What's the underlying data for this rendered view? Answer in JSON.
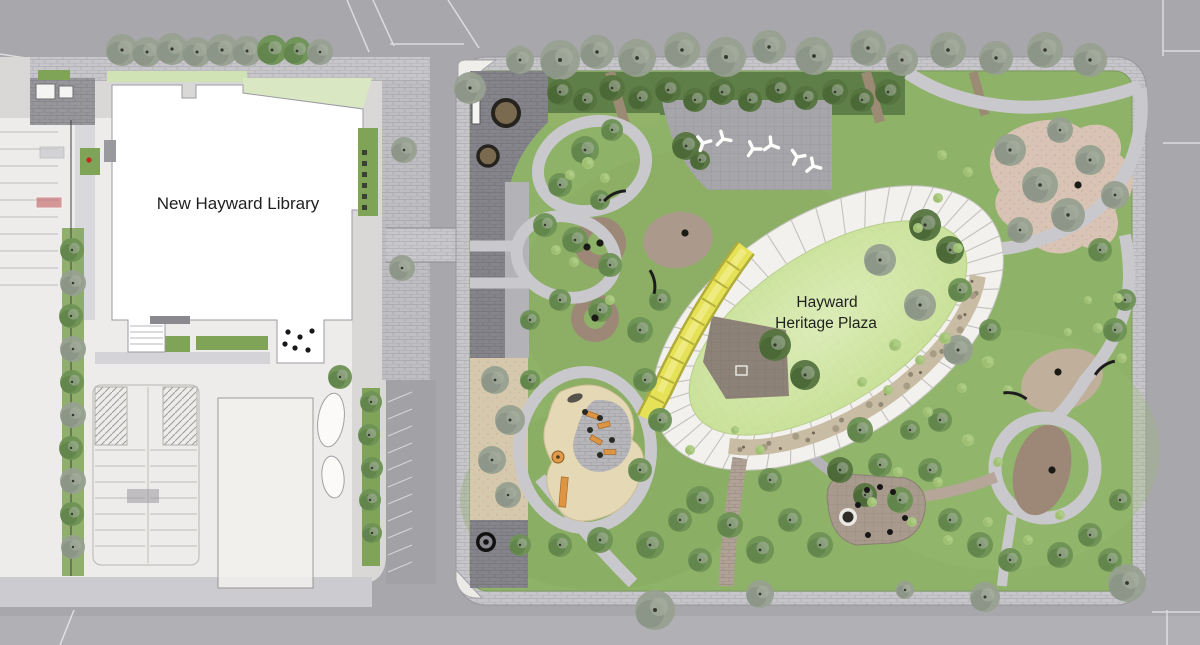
{
  "labels": {
    "library": "New Hayward Library",
    "plaza_line1": "Hayward",
    "plaza_line2": "Heritage Plaza"
  },
  "palette": {
    "street_gray": "#a8a7ac",
    "sidewalk_gray": "#c7c6ca",
    "park_lawn_green": "#8fb269",
    "oval_lawn_green": "#cfe5a2",
    "promenade_white": "#f2f1ee",
    "accent_path_yellow": "#e6e257",
    "plaza_paving_dark": "#85848b",
    "mulch_brown": "#9d8878",
    "sand_tan": "#e5d8b4",
    "building_white": "#ffffff",
    "label_ink": "#1f1f1f"
  }
}
